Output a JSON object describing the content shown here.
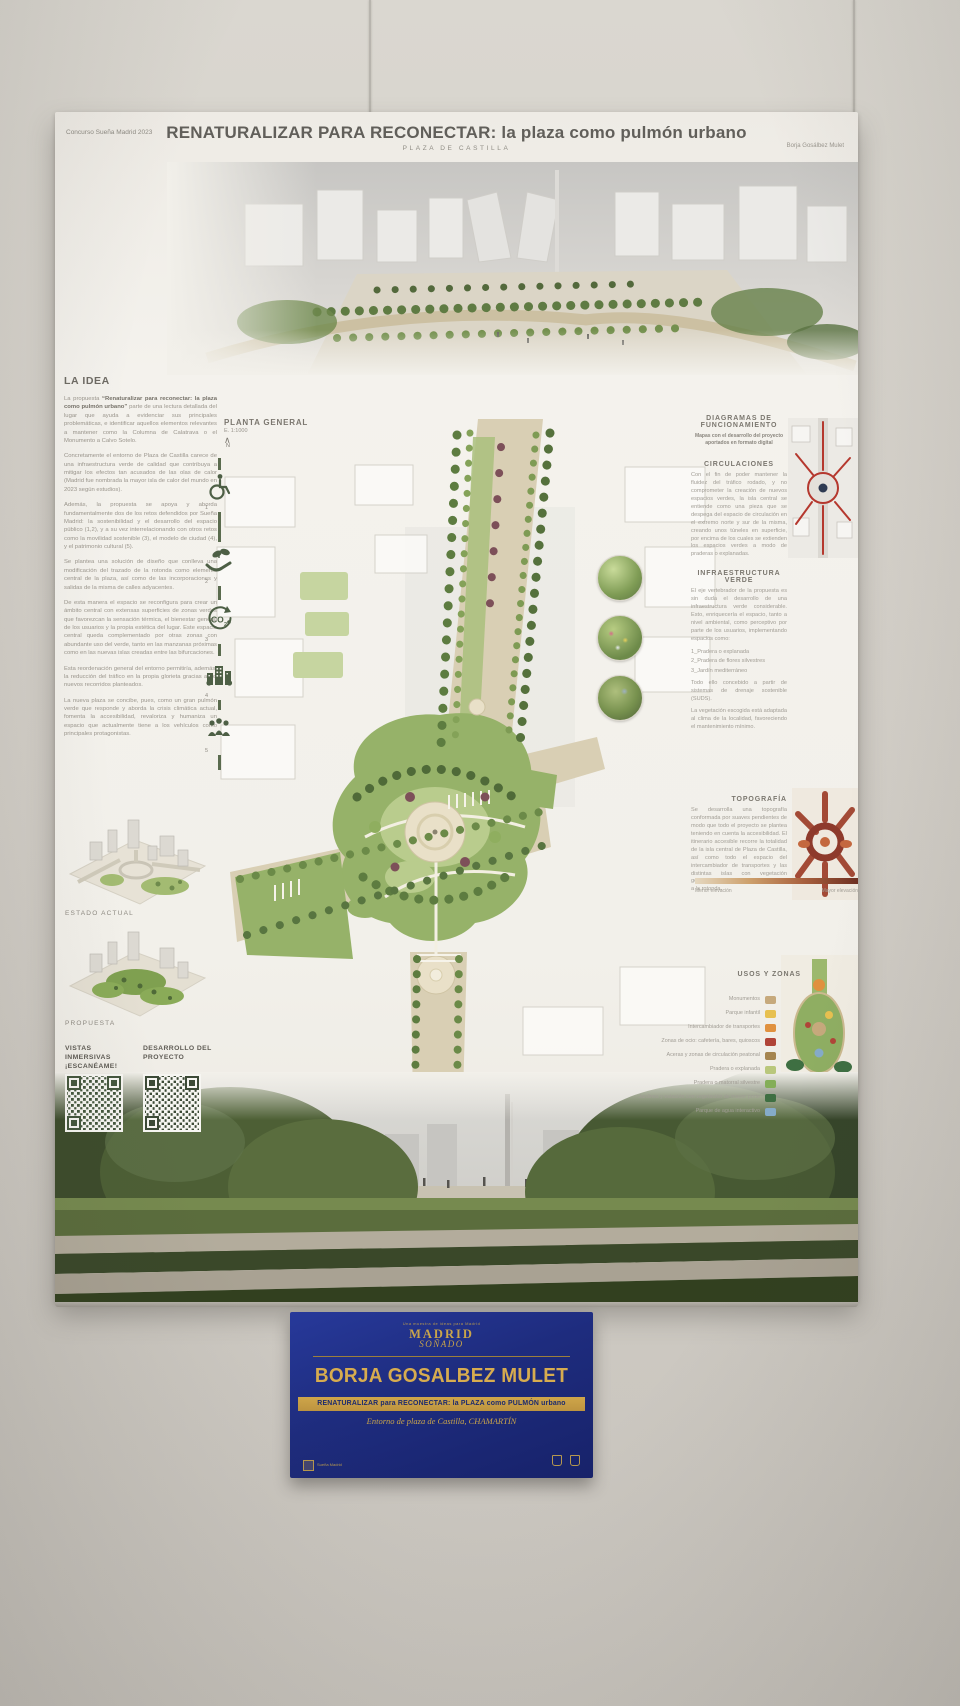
{
  "poster": {
    "header": {
      "competition": "Concurso Sueña Madrid 2023",
      "title": "RENATURALIZAR PARA RECONECTAR: la plaza como pulmón urbano",
      "subtitle": "PLAZA DE CASTILLA",
      "author": "Borja Gosálbez Mulet"
    },
    "la_idea": {
      "heading": "LA IDEA",
      "p1_pre": "La propuesta ",
      "p1_bold": "“Renaturalizar para reconectar: la plaza como pulmón urbano”",
      "p1_rest": " parte de una lectura detallada del lugar que ayuda a evidenciar sus principales problemáticas, e identificar aquellos elementos relevantes a mantener como la Columna de Calatrava o el Monumento a Calvo Sotelo.",
      "paragraphs": [
        "Concretamente el entorno de Plaza de Castilla carece de una infraestructura verde de calidad que contribuya a mitigar los efectos tan acusados de las olas de calor (Madrid fue nombrada la mayor isla de calor del mundo en 2023 según estudios).",
        "Además, la propuesta se apoya y aborda fundamentalmente dos de los retos defendidos por Sueña Madrid: la sostenibilidad y el desarrollo del espacio público (1,2), y a su vez interrelacionando con otros retos como la movilidad sostenible (3), el modelo de ciudad (4), y el patrimonio cultural (5).",
        "Se plantea una solución de diseño que conlleva una modificación del trazado de la rotonda como elemento central de la plaza, así como de las incorporaciones y salidas de la misma de calles adyacentes.",
        "De esta manera el espacio se reconfigura para crear un ámbito central con extensas superficies de zonas verdes que favorezcan la sensación térmica, el bienestar general de los usuarios y la propia estética del lugar. Este espacio central queda complementado por otras zonas con abundante uso del verde, tanto en las manzanas próximas como en las nuevas islas creadas entre las bifurcaciones.",
        "Esta reordenación general del entorno permitiría, además, la reducción del tráfico en la propia glorieta gracias a los nuevos recorridos planteados.",
        "La nueva plaza se concibe, pues, como un gran pulmón verde que responde y aborda la crisis climática actual, fomenta la accesibilidad, revaloriza y humaniza un espacio que actualmente tiene a los vehículos como principales protagonistas."
      ]
    },
    "planta": {
      "label": "PLANTA GENERAL",
      "scale": "E. 1:1000",
      "north_arrow": "∧",
      "north": "N"
    },
    "timeline": {
      "numbers": [
        "1",
        "2",
        "3",
        "4",
        "5"
      ]
    },
    "right_rail": {
      "diagramas": {
        "heading": "DIAGRAMAS DE FUNCIONAMIENTO",
        "note": "Mapas con el desarrollo del proyecto aportados en formato digital"
      },
      "circulaciones": {
        "heading": "CIRCULACIONES",
        "body": "Con el fin de poder mantener la fluidez del tráfico rodado, y no comprometer la creación de nuevos espacios verdes, la isla central se entiende como una pieza que se despega del espacio de circulación en el extremo norte y sur de la misma, creando unos túneles en superficie, por encima de los cuales se extienden los espacios verdes a modo de praderas o explanadas.",
        "thumb": "circulation-diagram"
      },
      "infraestructura": {
        "heading": "INFRAESTRUCTURA VERDE",
        "body": "El eje vertebrador de la propuesta es sin duda el desarrollo de una infraestructura verde considerable. Esto, enriquecería el espacio, tanto a nivel ambiental, como perceptivo por parte de los usuarios, implementando espacios como:",
        "list": [
          "1_Pradera o explanada",
          "2_Pradera de flores silvestres",
          "3_Jardín mediterráneo"
        ],
        "body2": "Todo ello concebido a partir de sistemas de drenaje sostenible (SUDS).",
        "body3": "La vegetación escogida está adaptada al clima de la localidad, favoreciendo el mantenimiento mínimo."
      },
      "topografia": {
        "heading": "TOPOGRAFÍA",
        "body": "Se desarrolla una topografía conformada por suaves pendientes de modo que todo el proyecto se plantea teniendo en cuenta la accesibilidad. El itinerario accesible recorre la totalidad de la isla central de Plaza de Castilla, así como todo el espacio del intercambiador de transportes y las distintas islas con vegetación generadas en las manzanas próximas a la rotonda.",
        "legend_low": "Menor elevación",
        "legend_high": "Mayor elevación"
      },
      "usos": {
        "heading": "USOS Y ZONAS",
        "items": [
          {
            "label": "Monumentos",
            "color": "#c6a97c"
          },
          {
            "label": "Parque infantil",
            "color": "#e7c050"
          },
          {
            "label": "Intercambiador de transportes",
            "color": "#e0913f"
          },
          {
            "label": "Zonas de ocio: cafetería, bares, quioscos",
            "color": "#b04438"
          },
          {
            "label": "Aceras y zonas de circulación peatonal",
            "color": "#a5854f"
          },
          {
            "label": "Pradera o explanada",
            "color": "#b9c77c"
          },
          {
            "label": "Pradera o matorral silvestre",
            "color": "#84ae58"
          },
          {
            "label": "Jardines y estación con vegetación de mayor porte",
            "color": "#3e6f42"
          },
          {
            "label": "Parque de agua interactivo",
            "color": "#85abc9"
          }
        ]
      }
    },
    "bottom_left": {
      "estado_label": "ESTADO ACTUAL",
      "propuesta_label": "PROPUESTA",
      "qr1_label": "VISTAS INMERSIVAS ¡ESCANÉAME!",
      "qr2_label": "DESARROLLO DEL PROYECTO"
    }
  },
  "plaque": {
    "pretitle": "Una muestra de ideas para Madrid",
    "logo_line1": "MADRID",
    "logo_line2": "SOÑADO",
    "name": "BORJA GOSALBEZ MULET",
    "project": "RENATURALIZAR para RECONECTAR: la PLAZA como PULMÓN urbano",
    "location": "Entorno de plaza de Castilla, CHAMARTÍN",
    "mini_logo": "Sueña Madrid"
  },
  "colors": {
    "poster_green": "#4d5f45",
    "plaque_blue": "#1e2c7e",
    "plaque_gold": "#c9a44b"
  }
}
